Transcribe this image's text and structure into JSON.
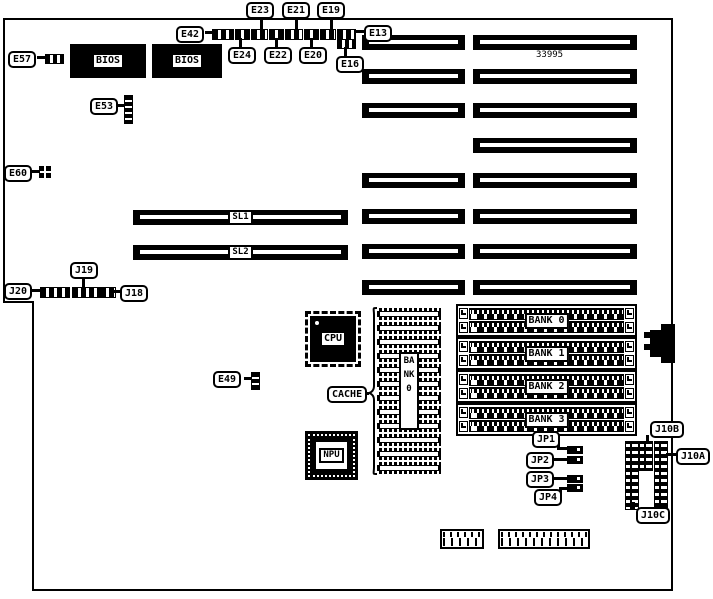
{
  "board": {
    "part_number": "33995",
    "callouts": {
      "E13": "E13",
      "E16": "E16",
      "E19": "E19",
      "E20": "E20",
      "E21": "E21",
      "E22": "E22",
      "E23": "E23",
      "E24": "E24",
      "E42": "E42",
      "E49": "E49",
      "E53": "E53",
      "E57": "E57",
      "E60": "E60",
      "J18": "J18",
      "J19": "J19",
      "J20": "J20",
      "JP1": "JP1",
      "JP2": "JP2",
      "JP3": "JP3",
      "JP4": "JP4",
      "J10A": "J10A",
      "J10B": "J10B",
      "J10C": "J10C",
      "CACHE": "CACHE"
    },
    "chips": {
      "bios1": "BIOS",
      "bios2": "BIOS",
      "cpu": "CPU",
      "npu": "NPU"
    },
    "slots": {
      "sl1": "SL1",
      "sl2": "SL2"
    },
    "memory_banks": [
      "BANK 0",
      "BANK 1",
      "BANK 2",
      "BANK 3"
    ],
    "dip_bank_vertical_label": "BANK0"
  }
}
